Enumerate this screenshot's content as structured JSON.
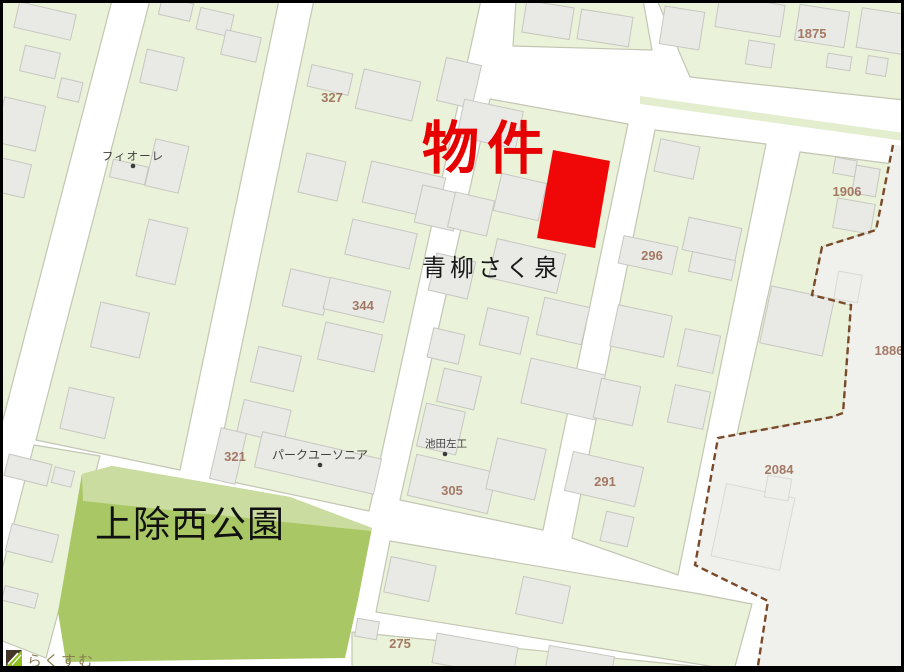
{
  "map": {
    "labels": {
      "bukken": "物件",
      "aoyagi": "青柳さく泉",
      "fiore": "フィオーレ",
      "park_yusonia": "パークユーソニア",
      "ikeda_sakou": "池田左工",
      "kamiyoke_park": "上除西公園",
      "logo": "らくすむ"
    },
    "parcels": {
      "p327": "327",
      "p344": "344",
      "p321": "321",
      "p305": "305",
      "p291": "291",
      "p296": "296",
      "p275": "275",
      "p1875": "1875",
      "p1906": "1906",
      "p1886": "1886",
      "p2084": "2084"
    },
    "colors": {
      "property_red": "#f00808",
      "bukken_text_red": "#e60000",
      "park_green": "#a9c765",
      "park_green_light": "#cadc9f",
      "block_green": "#eaf2da",
      "outside_gray": "#f0f0ed",
      "boundary_brown": "#7a4a28",
      "parcel_label_brown": "#9c6d57",
      "logo_olive": "#8b7c52"
    }
  }
}
